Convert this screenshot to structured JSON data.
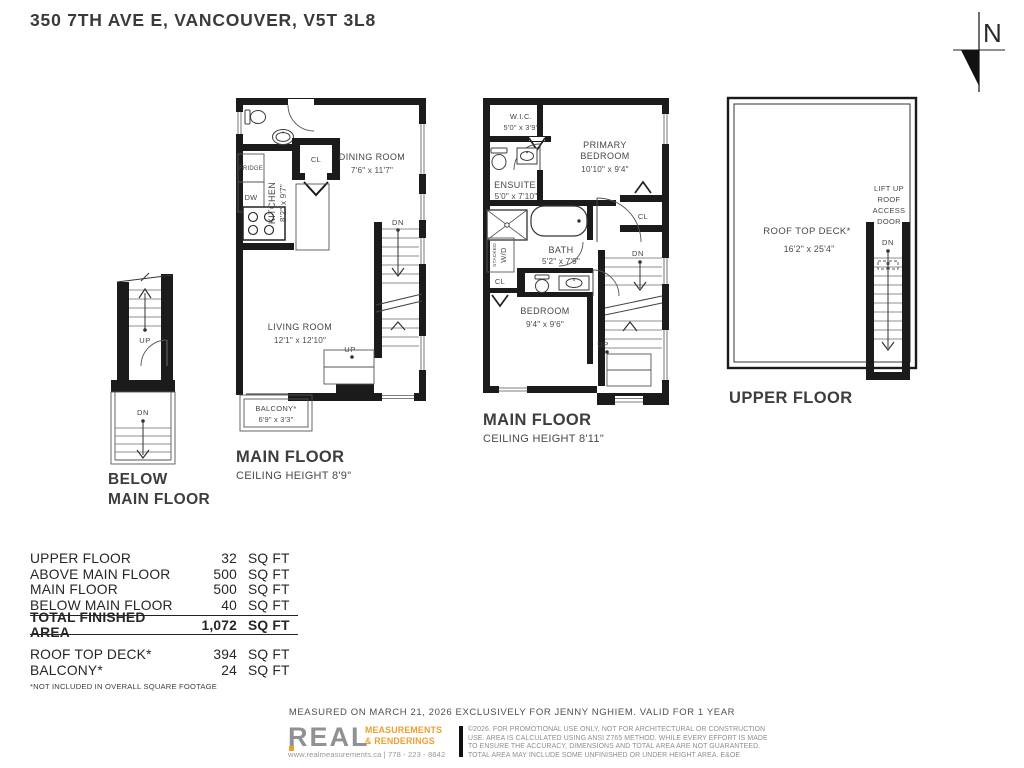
{
  "header": {
    "address": "350 7TH AVE E, VANCOUVER, V5T 3L8",
    "north_label": "N"
  },
  "below_main_plan": {
    "up_label": "UP",
    "dn_label": "DN",
    "name_line1": "BELOW",
    "name_line2": "MAIN FLOOR"
  },
  "main_floor_left_plan": {
    "name": "MAIN FLOOR",
    "ceiling": "CEILING HEIGHT 8'9\"",
    "closet_label": "CL",
    "fridge_label": "FRIDGE",
    "dishwasher_label": "DW",
    "kitchen_label": "KITCHEN",
    "kitchen_dims": "8'2\" x 9'7\"",
    "dining_label": "DINING ROOM",
    "dining_dims": "7'6\" x 11'7\"",
    "living_label": "LIVING ROOM",
    "living_dims": "12'1\" x 12'10\"",
    "balcony_label": "BALCONY*",
    "balcony_dims": "6'9\" x 3'3\"",
    "dn_label": "DN",
    "up_label": "UP"
  },
  "main_floor_right_plan": {
    "name": "MAIN FLOOR",
    "ceiling": "CEILING HEIGHT 8'11\"",
    "wic_label": "W.I.C.",
    "wic_dims": "5'0\" x 3'9\"",
    "primary_label_line1": "PRIMARY",
    "primary_label_line2": "BEDROOM",
    "primary_dims": "10'10\" x 9'4\"",
    "ensuite_label": "ENSUITE",
    "ensuite_dims": "5'0\" x 7'10\"",
    "bath_label": "BATH",
    "bath_dims": "5'2\" x 7'9\"",
    "bedroom_label": "BEDROOM",
    "bedroom_dims": "9'4\" x 9'6\"",
    "washer_label_line1": "STACKED",
    "washer_label_line2": "W/D",
    "closet1_label": "CL",
    "closet2_label": "CL",
    "dn_label": "DN",
    "up_label": "UP"
  },
  "upper_floor_plan": {
    "name": "UPPER FLOOR",
    "deck_label": "ROOF TOP DECK*",
    "deck_dims": "16'2\" x 25'4\"",
    "access_line1": "LIFT UP",
    "access_line2": "ROOF",
    "access_line3": "ACCESS",
    "access_line4": "DOOR",
    "dn_label": "DN"
  },
  "area_table": {
    "rows": [
      {
        "label": "UPPER FLOOR",
        "value": "32",
        "unit": "SQ FT"
      },
      {
        "label": "ABOVE MAIN FLOOR",
        "value": "500",
        "unit": "SQ FT"
      },
      {
        "label": "MAIN FLOOR",
        "value": "500",
        "unit": "SQ FT"
      },
      {
        "label": "BELOW MAIN FLOOR",
        "value": "40",
        "unit": "SQ FT"
      }
    ],
    "total": {
      "label": "TOTAL FINISHED AREA",
      "value": "1,072",
      "unit": "SQ FT"
    },
    "excluded_rows": [
      {
        "label": "ROOF TOP DECK*",
        "value": "394",
        "unit": "SQ FT"
      },
      {
        "label": "BALCONY*",
        "value": "24",
        "unit": "SQ FT"
      }
    ],
    "footnote": "*NOT INCLUDED IN OVERALL SQUARE FOOTAGE"
  },
  "footer": {
    "measured_line": "MEASURED ON MARCH 21, 2026 EXCLUSIVELY FOR JENNY NGHIEM. VALID FOR 1 YEAR",
    "logo": {
      "wordmark": "REAL",
      "sub_line1": "MEASUREMENTS",
      "sub_line2": "& RENDERINGS",
      "contact": "www.realmeasurements.ca | 778 - 223 - 8842"
    },
    "disclaimer_line1": "©2026. FOR PROMOTIONAL USE ONLY, NOT FOR ARCHITECTURAL OR CONSTRUCTION",
    "disclaimer_line2": "USE. AREA IS CALCULATED USING ANSI Z765 METHOD. WHILE EVERY EFFORT IS MADE",
    "disclaimer_line3": "TO ENSURE THE ACCURACY, DIMENSIONS AND TOTAL AREA ARE NOT GUARANTEED.",
    "disclaimer_line4": "TOTAL AREA MAY INCLUDE SOME UNFINISHED OR UNDER HEIGHT AREA. E&OE"
  },
  "colors": {
    "wall": "#1b1b1b",
    "brand_orange": "#EE9E2E",
    "brand_gray": "#8F9194",
    "text_dark": "#3C3C3C"
  }
}
